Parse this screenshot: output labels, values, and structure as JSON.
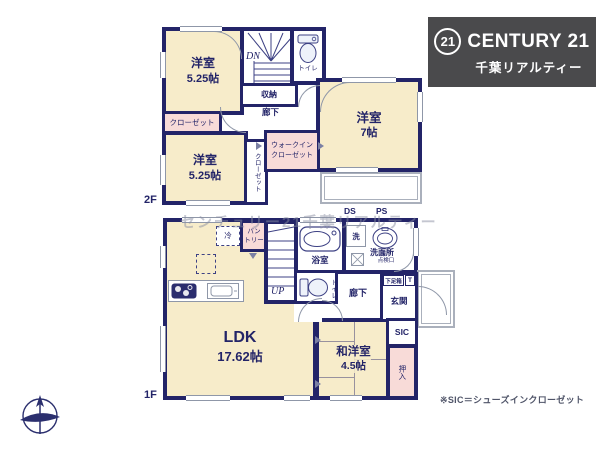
{
  "colors": {
    "wall": "#232468",
    "room_fill": "#f7ecca",
    "closet_fill": "#f8dbd8",
    "logo_bg": "#4a4a4c",
    "line_gray": "#8f97a8"
  },
  "logo": {
    "mark": "21",
    "brand": "CENTURY 21",
    "subtitle": "千葉リアルティー"
  },
  "watermark": "センチュリー21千葉リアルティー",
  "note": "※SIC＝シューズインクローゼット",
  "icons": {
    "seal": "century21-seal-icon",
    "compass": "compass-north-icon",
    "toilet": "toilet-icon",
    "bathtub": "bathtub-icon",
    "basin": "washbasin-icon",
    "stove": "stove-icon",
    "sink": "kitchen-sink-icon",
    "stairs": "stairs-icon",
    "hatch": "floor-hatch-icon"
  },
  "floor2": {
    "floor_label": "2F",
    "room_west1": {
      "name": "洋室",
      "size": "5.25帖"
    },
    "closet_a": "クローゼット",
    "room_west2": {
      "name": "洋室",
      "size": "5.25帖"
    },
    "closet_b": "クローゼット",
    "stairs": "DN",
    "storage": "収納",
    "hallway": "廊下",
    "toilet": "トイレ",
    "room_west3": {
      "name": "洋室",
      "size": "7帖"
    },
    "wic": {
      "line1": "ウォークイン",
      "line2": "クローゼット"
    }
  },
  "floor1": {
    "floor_label": "1F",
    "duct": "DS",
    "pipe": "PS",
    "fridge": "冷",
    "pantry": {
      "line1": "パン",
      "line2": "トリー"
    },
    "stairs": "UP",
    "bathroom": "浴室",
    "washer": "洗",
    "washroom": "洗面所",
    "hatch": {
      "line1": "床下",
      "line2": "点検口"
    },
    "toilet": "トイレ",
    "hallway": "廊下",
    "shoebox": "下足箱",
    "shoebox_t": "T",
    "entrance": "玄関",
    "sic": "SIC",
    "ldk": {
      "name": "LDK",
      "size": "17.62帖"
    },
    "washitsu": {
      "name": "和洋室",
      "size": "4.5帖"
    },
    "oshiire": "押入"
  }
}
